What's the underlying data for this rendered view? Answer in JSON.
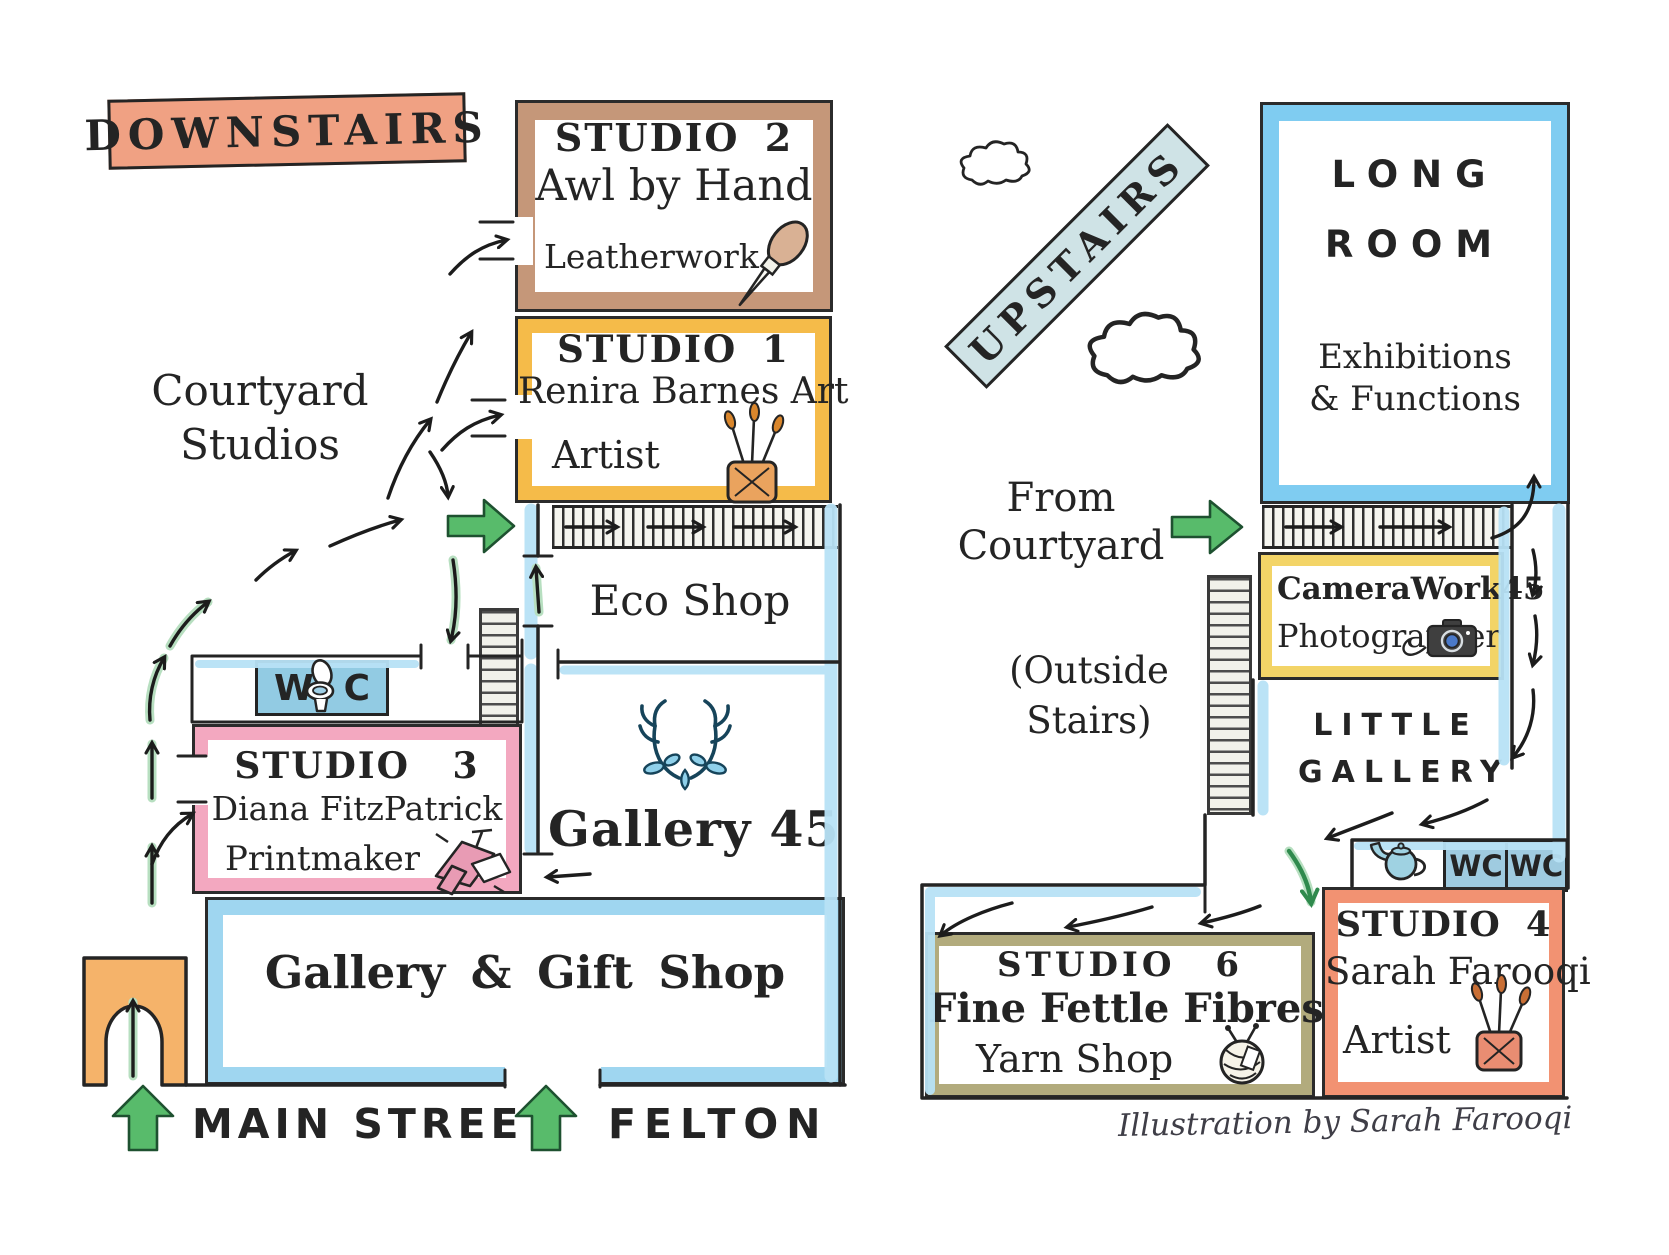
{
  "credit": "Illustration by Sarah Farooqi",
  "colors": {
    "downstairs_label": "#f0a183",
    "upstairs_label": "#cfe3e6",
    "studio2_border": "#c59779",
    "studio1_border": "#f5bb49",
    "camerawork_border": "#f3d467",
    "studio3_border": "#f3a8c0",
    "studio4_border": "#f29272",
    "studio6_border": "#b2ab7d",
    "wc_fill": "#92cbe3",
    "wall_blue": "#b8e2f6",
    "arrow_green": "#58bb6b"
  },
  "downstairs": {
    "section_label": "DOWNSTAIRS",
    "courtyard": {
      "line1": "Courtyard",
      "line2": "Studios"
    },
    "studio2": {
      "title": "STUDIO 2",
      "name": "Awl by Hand",
      "craft": "Leatherwork"
    },
    "studio1": {
      "title": "STUDIO 1",
      "name": "Renira Barnes Art",
      "craft": "Artist"
    },
    "eco_shop": "Eco Shop",
    "gallery45": "Gallery 45",
    "wc": {
      "left": "W",
      "right": "C"
    },
    "studio3": {
      "title": "STUDIO 3",
      "name": "Diana FitzPatrick",
      "craft": "Printmaker"
    },
    "gift_shop": "Gallery & Gift Shop",
    "street": {
      "name": "MAIN STREET",
      "town": "FELTON"
    }
  },
  "upstairs": {
    "section_label": "UPSTAIRS",
    "long_room": {
      "title_line1": "LONG",
      "title_line2": "ROOM",
      "sub_line1": "Exhibitions",
      "sub_line2": "& Functions"
    },
    "from_courtyard": {
      "line1": "From",
      "line2": "Courtyard"
    },
    "outside_stairs": {
      "line1": "(Outside",
      "line2": "Stairs)"
    },
    "camerawork": {
      "name": "CameraWork45",
      "craft": "Photographer"
    },
    "little_gallery": {
      "line1": "LITTLE",
      "line2": "GALLERY"
    },
    "wc_left": "WC",
    "wc_right": "WC",
    "studio4": {
      "title": "STUDIO 4",
      "name": "Sarah Farooqi",
      "craft": "Artist"
    },
    "studio6": {
      "title": "STUDIO 6",
      "name": "Fine Fettle Fibres",
      "craft": "Yarn Shop"
    }
  }
}
